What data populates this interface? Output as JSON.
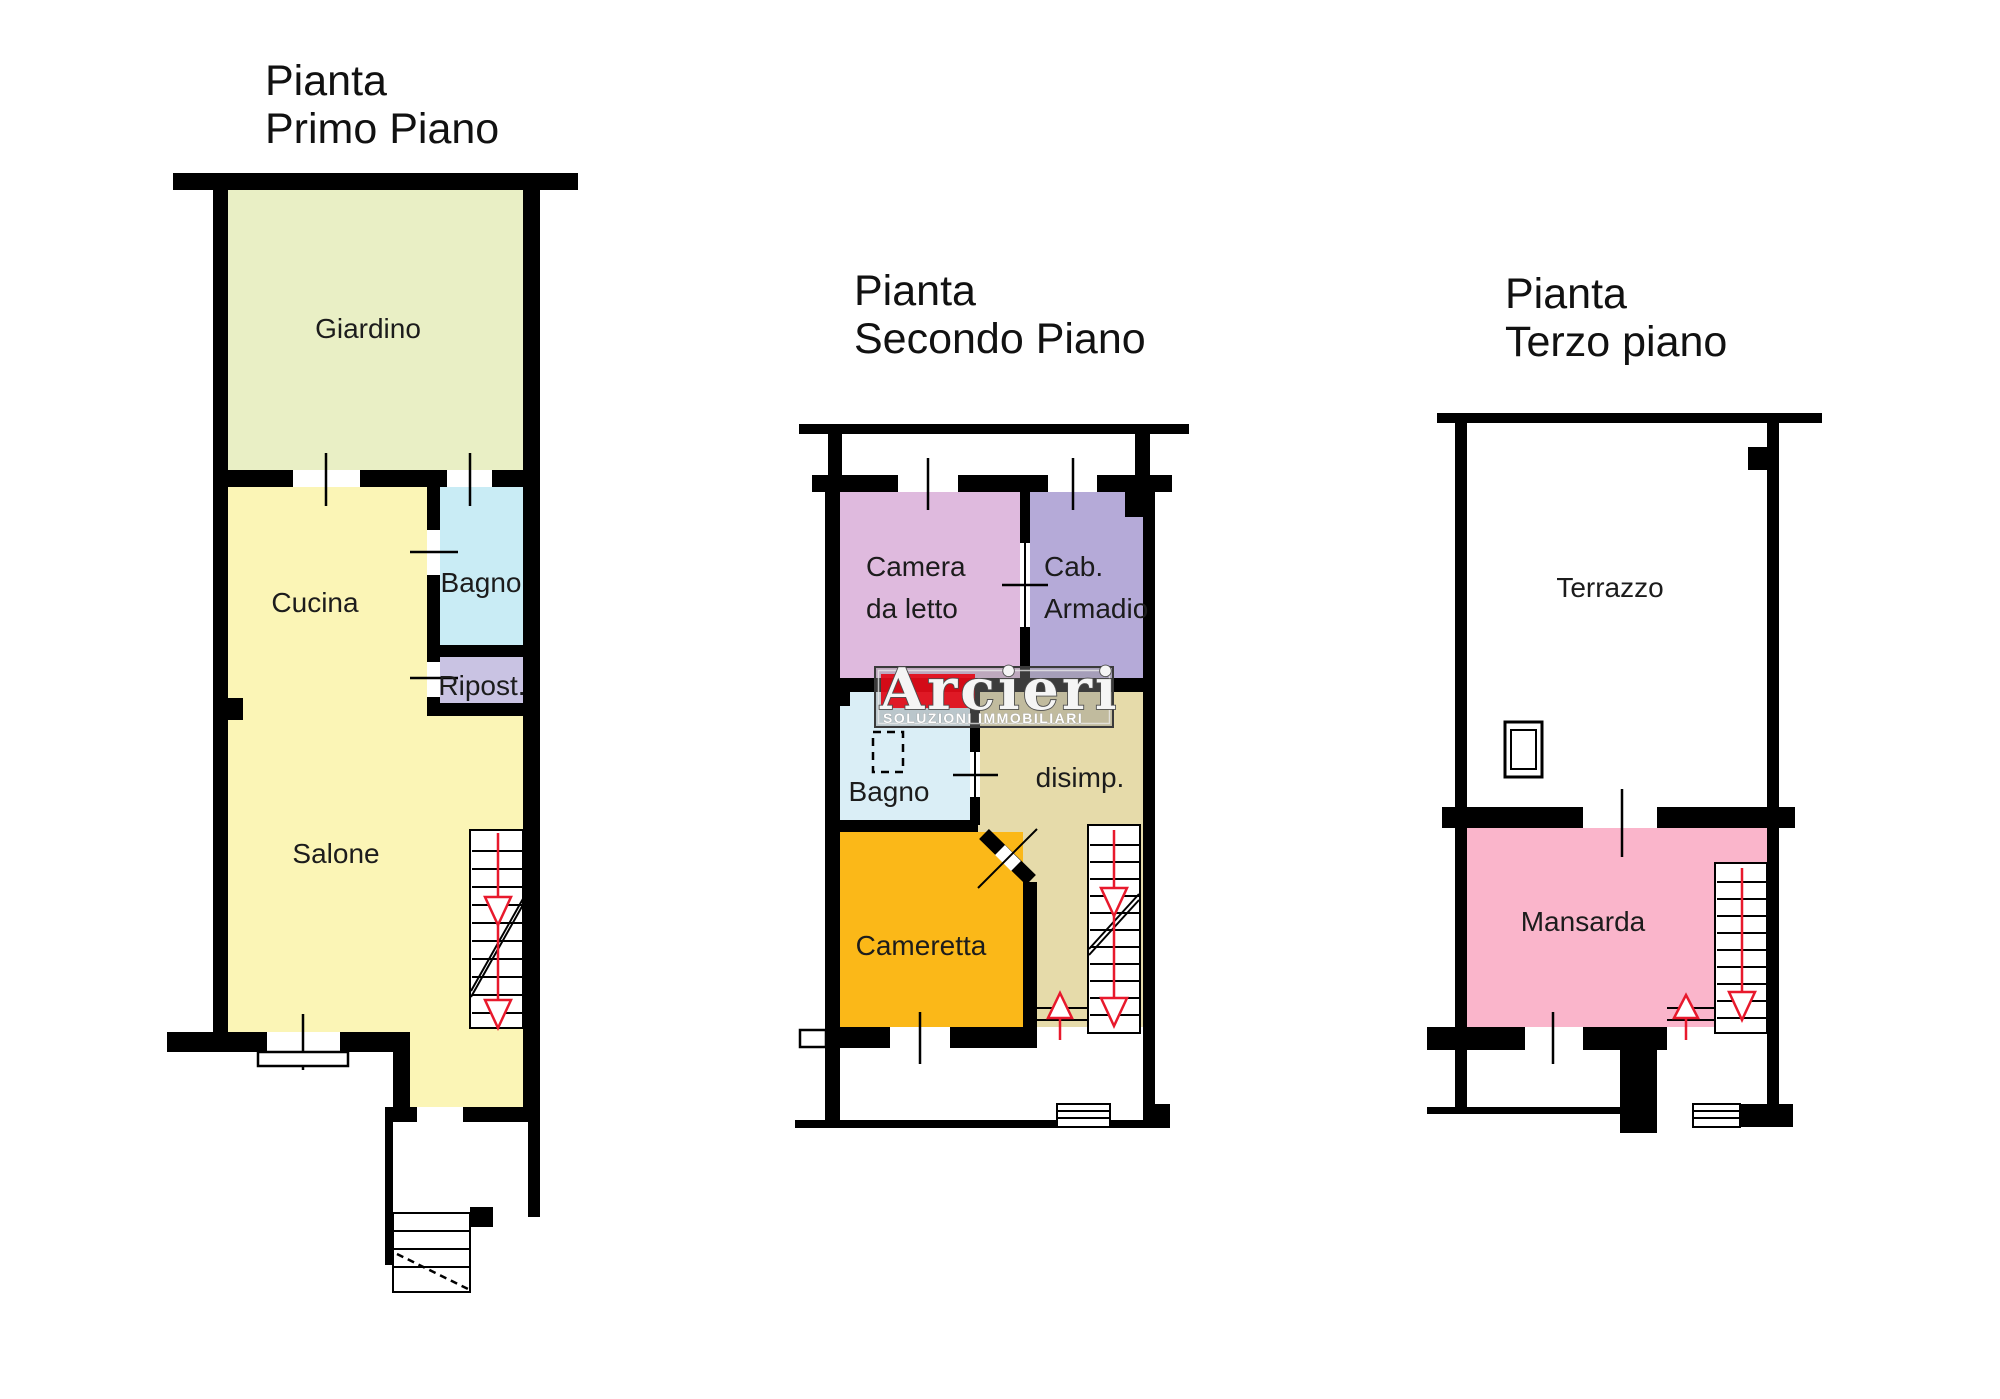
{
  "watermark": {
    "brand": "Arcieri",
    "tagline": "SOLUZIONI IMMOBILIARI",
    "red": "#e30613"
  },
  "colors": {
    "wall": "#000000",
    "giardino": "#e9efc5",
    "cucina_salone": "#fbf5b6",
    "bagno_p1": "#c9ecf5",
    "ripost": "#c9c3e3",
    "camera": "#dfbade",
    "cab_armadio": "#b5aad8",
    "bagno_p2": "#daeef6",
    "disimp": "#e6dbaa",
    "cameretta": "#fbb818",
    "mansarda": "#fab5cb",
    "stair_red": "#e8192c",
    "text": "#1c1c1c"
  },
  "plans": [
    {
      "title_line1": "Pianta",
      "title_line2": "Primo Piano",
      "rooms": {
        "giardino": "Giardino",
        "cucina": "Cucina",
        "bagno": "Bagno",
        "ripost": "Ripost.",
        "salone": "Salone"
      }
    },
    {
      "title_line1": "Pianta",
      "title_line2": "Secondo Piano",
      "rooms": {
        "camera_line1": "Camera",
        "camera_line2": "da letto",
        "cab_line1": "Cab.",
        "cab_line2": "Armadio",
        "bagno": "Bagno",
        "disimp": "disimp.",
        "cameretta": "Cameretta"
      }
    },
    {
      "title_line1": "Pianta",
      "title_line2": "Terzo piano",
      "rooms": {
        "terrazzo": "Terrazzo",
        "mansarda": "Mansarda"
      }
    }
  ]
}
